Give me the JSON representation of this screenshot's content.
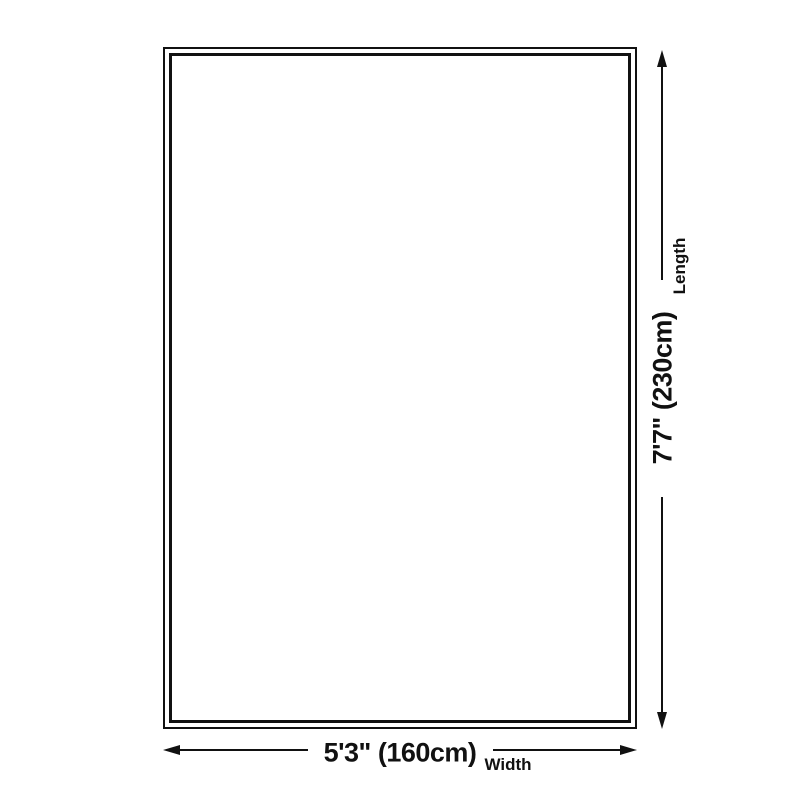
{
  "dimensions": {
    "width": {
      "value": "5'3\" (160cm)",
      "label": "Width"
    },
    "length": {
      "value": "7'7\" (230cm)",
      "label": "Length"
    }
  },
  "colors": {
    "line": "#111111",
    "background": "#ffffff"
  }
}
